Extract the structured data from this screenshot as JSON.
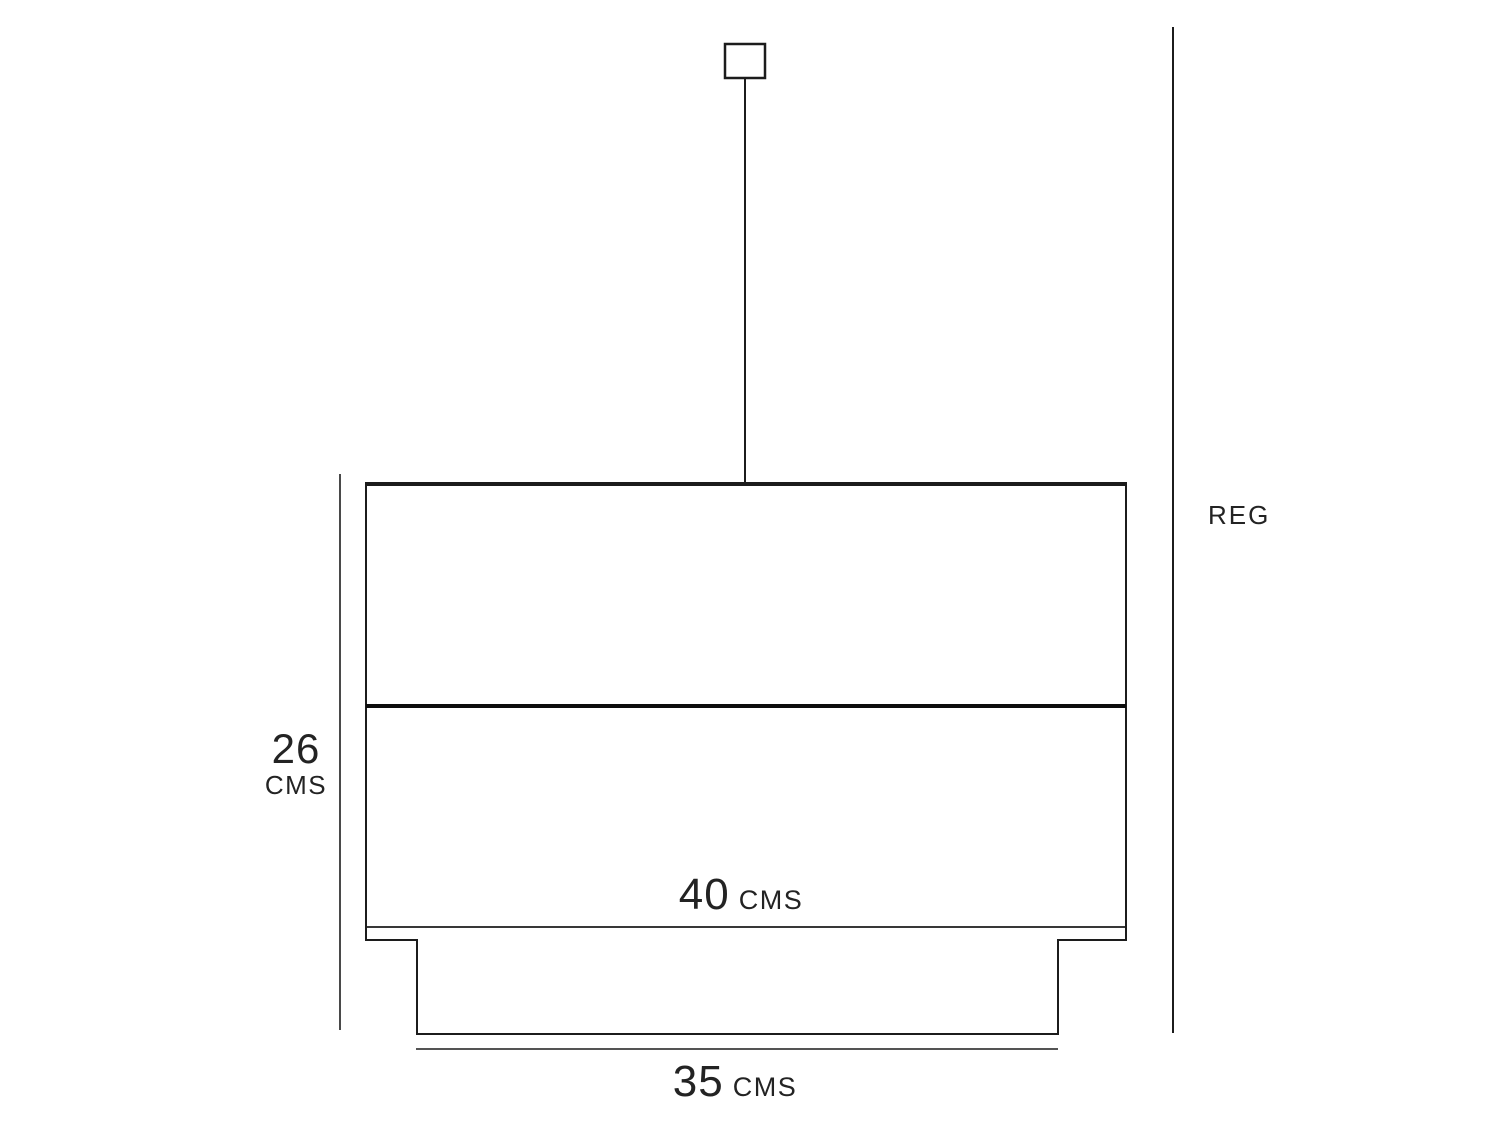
{
  "diagram": {
    "type": "pendant-lamp-dimension-drawing",
    "labels": {
      "height": {
        "value": "26",
        "unit": "CMS"
      },
      "shade_width": {
        "value": "40",
        "unit": "CMS"
      },
      "diffuser_width": {
        "value": "35",
        "unit": "CMS"
      },
      "suspension": "REG"
    },
    "colors": {
      "line": "#1c1c1c",
      "divider": "#0d0d0d",
      "text": "#232323",
      "background": "#ffffff"
    }
  }
}
